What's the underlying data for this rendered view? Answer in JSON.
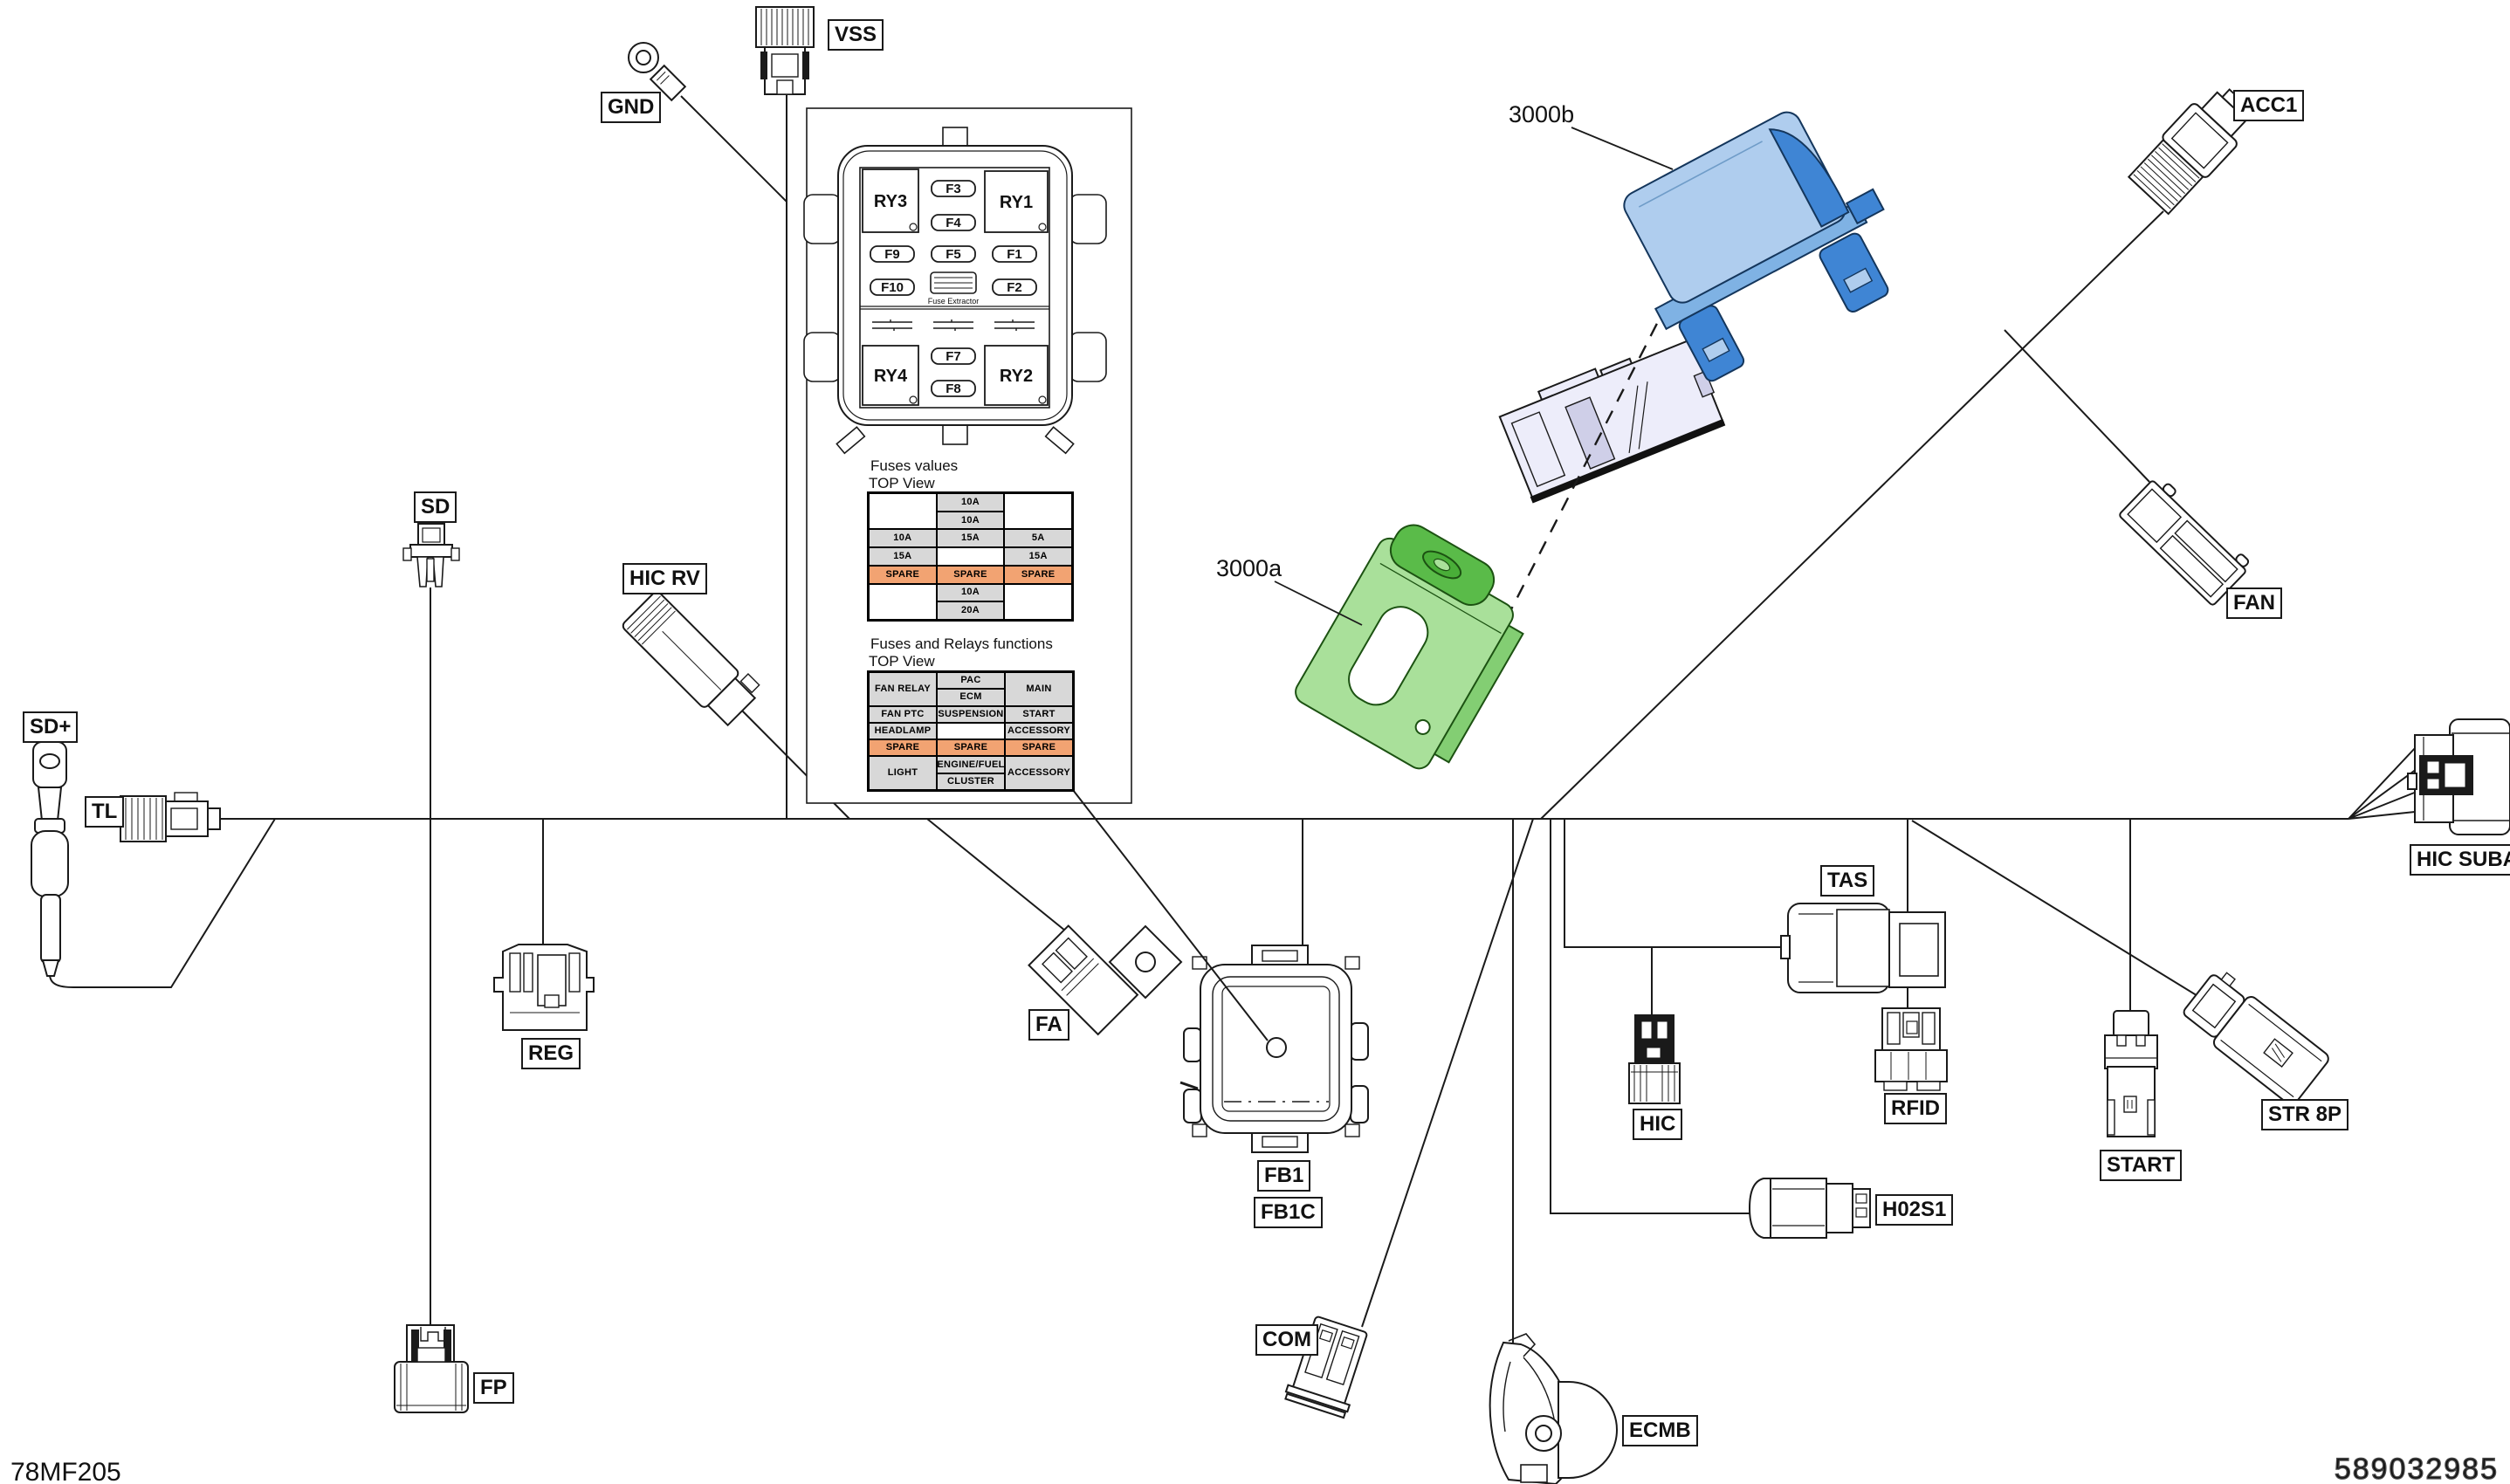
{
  "footer": {
    "left": "78MF205",
    "right": "589032985"
  },
  "colors": {
    "line": "#1a1a1a",
    "cell_gray": "#D8D8D8",
    "cell_orange": "#F2A372",
    "part_blue_light": "#AFCDEE",
    "part_blue_mid": "#7FB2E4",
    "part_blue_dark": "#3F85D4",
    "part_green_light": "#A9E09A",
    "part_green_mid": "#5ABB49",
    "part_green_dark": "#49AE38",
    "part_lavender": "#EDEDFA"
  },
  "connectors": {
    "vss": {
      "label": "VSS"
    },
    "gnd": {
      "label": "GND"
    },
    "sd": {
      "label": "SD"
    },
    "sd_plus": {
      "label": "SD+"
    },
    "tl": {
      "label": "TL"
    },
    "hic_rv": {
      "label": "HIC RV"
    },
    "reg": {
      "label": "REG"
    },
    "fp": {
      "label": "FP"
    },
    "fa": {
      "label": "FA"
    },
    "fb1": {
      "label": "FB1"
    },
    "fb1c": {
      "label": "FB1C"
    },
    "com": {
      "label": "COM"
    },
    "ecmb": {
      "label": "ECMB"
    },
    "hic": {
      "label": "HIC"
    },
    "tas": {
      "label": "TAS"
    },
    "rfid": {
      "label": "RFID"
    },
    "h02s1": {
      "label": "H02S1"
    },
    "start": {
      "label": "START"
    },
    "str8p": {
      "label": "STR 8P"
    },
    "fan": {
      "label": "FAN"
    },
    "acc1": {
      "label": "ACC1"
    },
    "hic_suba": {
      "label": "HIC SUBA"
    }
  },
  "parts": {
    "p3000a": {
      "label": "3000a"
    },
    "p3000b": {
      "label": "3000b"
    }
  },
  "fusebox": {
    "relays": {
      "ry1": "RY1",
      "ry2": "RY2",
      "ry3": "RY3",
      "ry4": "RY4"
    },
    "fuses": {
      "f1": "F1",
      "f2": "F2",
      "f3": "F3",
      "f4": "F4",
      "f5": "F5",
      "f7": "F7",
      "f8": "F8",
      "f9": "F9",
      "f10": "F10"
    },
    "extractor": "Fuse Extractor"
  },
  "fuse_values": {
    "title": "Fuses values",
    "view": "TOP View",
    "grid": [
      [
        "",
        "10A",
        ""
      ],
      [
        "",
        "10A",
        ""
      ],
      [
        "10A",
        "15A",
        "5A"
      ],
      [
        "15A",
        "",
        "15A"
      ],
      [
        "SPARE",
        "SPARE",
        "SPARE"
      ],
      [
        "",
        "10A",
        ""
      ],
      [
        "",
        "20A",
        ""
      ]
    ]
  },
  "fuse_functions": {
    "title": "Fuses and Relays functions",
    "view": "TOP View",
    "grid": [
      [
        "FAN RELAY",
        "PAC",
        "MAIN"
      ],
      [
        "",
        "ECM",
        ""
      ],
      [
        "FAN PTC",
        "SUSPENSION",
        "START"
      ],
      [
        "HEADLAMP",
        "",
        "ACCESSORY"
      ],
      [
        "SPARE",
        "SPARE",
        "SPARE"
      ],
      [
        "LIGHT",
        "ENGINE/FUEL",
        "ACCESSORY"
      ],
      [
        "",
        "CLUSTER",
        ""
      ]
    ]
  }
}
